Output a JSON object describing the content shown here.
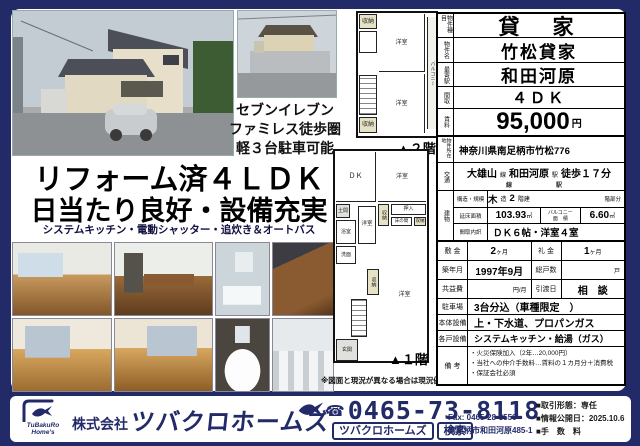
{
  "accent_color": "#232a68",
  "headline": {
    "line1": "リフォーム済４ＬＤＫ",
    "line2": "日当たり良好・設備充実",
    "sub": "システムキッチン・電動シャッター・追炊き＆オートバス"
  },
  "poi_note": {
    "line1": "セブンイレブン",
    "line2": "ファミレス徒歩圏",
    "line3": "軽３台駐車可能"
  },
  "plans": {
    "note": "※図面と現況が異なる場合は現況優先",
    "floor2": {
      "caption": "▲２階",
      "rooms": {
        "closet_top": "収納",
        "room1": "洋室",
        "room2": "洋室",
        "closet_bottom": "収納",
        "balcony": "バルコニー"
      }
    },
    "floor1": {
      "caption": "▲１階",
      "rooms": {
        "dk": "ＤＫ",
        "room_ne": "洋室",
        "doma": "土間",
        "bath": "浴室",
        "wash": "洗面",
        "room_w": "洋室",
        "closet_a": "収納",
        "oshiire": "押入",
        "tokonoma": "床の間",
        "closet_b": "収納",
        "closet_c": "収納",
        "room_s": "洋室",
        "genkan": "玄関"
      }
    }
  },
  "spec": {
    "type_label": "物件種目",
    "type_value": "貸　家",
    "name_label": "物件名",
    "name_value": "竹松貸家",
    "station_label": "最寄駅",
    "station_value": "和田河原",
    "madori_label": "間取",
    "madori_value": "４ＤＫ",
    "rent_label": "賃料",
    "rent_value": "95,000",
    "rent_unit": "円",
    "address_label": "物件所在地",
    "address_value": "神奈川県南足柄市竹松776",
    "access_label": "交通",
    "access_line": "大雄山",
    "access_line_unit": "線",
    "access_station": "和田河原",
    "access_station_unit": "駅",
    "access_walk": "徒歩１７分",
    "access_line_unit2": "線",
    "access_station_unit2": "駅",
    "building_label": "建物",
    "structure_label": "構造・規模",
    "structure_value": "木",
    "structure_unit": "造",
    "floors_value": "2",
    "floors_unit": "階建",
    "floor_part": "階部分",
    "area_label": "延床面積",
    "area_value": "103.93",
    "area_unit": "㎡",
    "balcony_label1": "バルコニー",
    "balcony_label2": "面　積",
    "balcony_value": "6.60",
    "balcony_unit": "㎡",
    "madori_detail_label": "間取内訳",
    "madori_detail_value": "ＤＫ６帖・洋室４室",
    "shikikin_label": "敷 金",
    "shikikin_value": "2",
    "shikikin_unit": "ヶ月",
    "reikin_label": "礼 金",
    "reikin_value": "1",
    "reikin_unit": "ヶ月",
    "built_label": "築年月",
    "built_value": "1997年9月",
    "units_label": "総戸数",
    "units_value": "",
    "units_unit": "戸",
    "kyoueki_label": "共益費",
    "kyoueki_value": "",
    "kyoueki_unit": "円/月",
    "hikiwatashi_label": "引渡日",
    "hikiwatashi_value": "相　談",
    "parking_label": "駐車場",
    "parking_value": "3台分込（車種限定　）",
    "setsubi_label": "本体設備",
    "setsubi_value": "上・下水道、プロパンガス",
    "kakudo_label": "各戸設備",
    "kakudo_value": "システムキッチン・給湯（ガス）",
    "biko_label": "備 考",
    "biko1": "・火災保険加入（2年…20,000円）",
    "biko2": "・当社への仲介手数料…賃料の１カ月分＋消費税",
    "biko3": "・保証会社必須"
  },
  "footer": {
    "logo_line1": "TuBakuRo",
    "logo_line2": "Home's",
    "company_prefix": "株式会社",
    "company_name": "ツバクロホームズ",
    "phone_icon": "☎",
    "phone": "0465-73-8118",
    "search_text": "ツバクロホームズ",
    "search_button": "検索",
    "fax": "Fax: 0465-28-3556",
    "address": "南足柄市和田河原485-1",
    "deal_type": "■取引形態：専任",
    "published": "■情報公開日：2025.10.6",
    "fee": "■手　数　料"
  }
}
